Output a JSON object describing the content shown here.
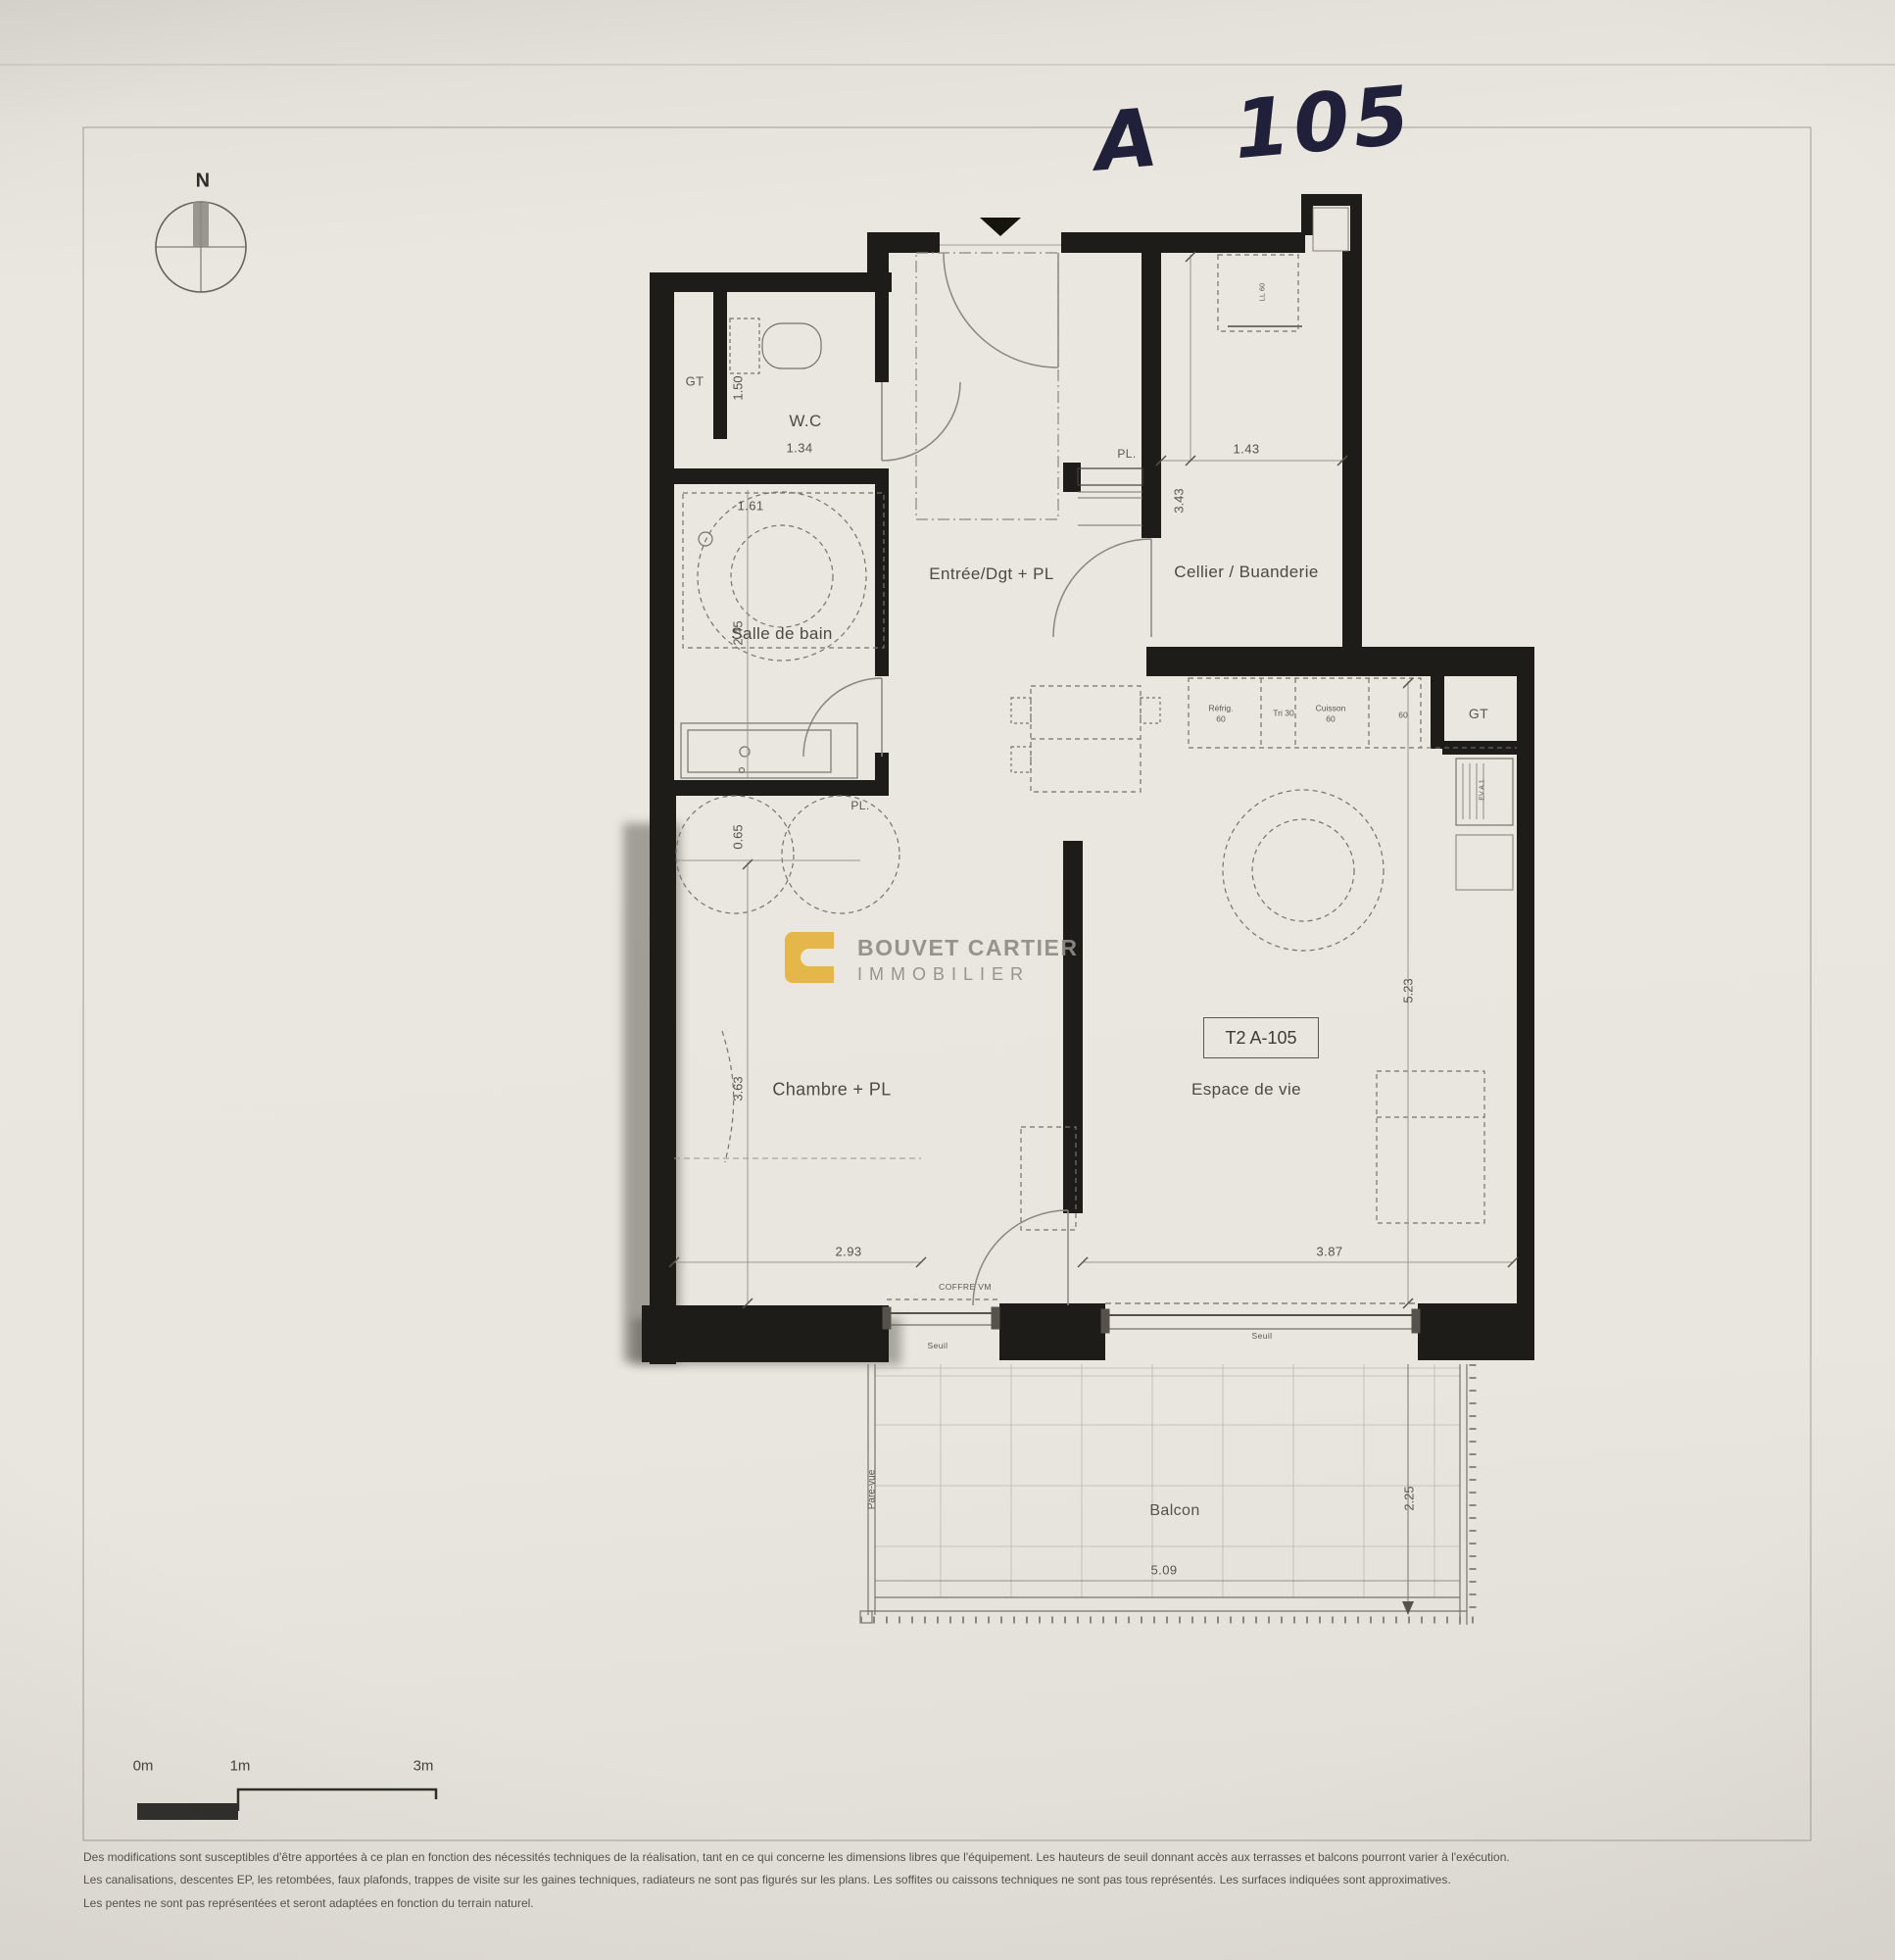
{
  "note": {
    "handwritten": "A 105"
  },
  "compass": {
    "north": "N"
  },
  "plan": {
    "unit_box_label": "T2 A-105",
    "rooms": {
      "wc": "W.C",
      "bathroom": "Salle de bain",
      "entry": "Entrée/Dgt + PL",
      "cellar": "Cellier / Buanderie",
      "bedroom": "Chambre + PL",
      "living": "Espace de vie",
      "balcony": "Balcon"
    },
    "dimensions": {
      "wc_width": "1.34",
      "wc_depth": "1.50",
      "bathroom_width": "1.61",
      "bathroom_depth": "2.45",
      "cellar_width": "1.43",
      "cellar_depth": "3.43",
      "bedroom_closet_depth": "0.65",
      "bedroom_depth": "3.63",
      "bedroom_width": "2.93",
      "living_width": "3.87",
      "living_depth": "5.23",
      "balcony_width": "5.09",
      "balcony_depth": "2.25"
    },
    "labels": {
      "gt_left": "GT",
      "gt_right": "GT",
      "pl_entry": "PL.",
      "pl_bedroom": "PL.",
      "coffre": "COFFRE VM",
      "seuil_bedroom": "Seuil",
      "seuil_living": "Seuil",
      "pare_vue": "Pare-vue",
      "washing_machine": "LL 60",
      "sink_unit": "EV A.1"
    },
    "kitchen": {
      "fridge": "Réfrig.",
      "fridge_size": "60",
      "bin": "Tri 30",
      "cooking": "Cuisson",
      "cooking_size": "60",
      "worktop_size": "60"
    }
  },
  "logo": {
    "line1": "BOUVET CARTIER",
    "line2": "IMMOBILIER"
  },
  "scale_bar": {
    "zero": "0m",
    "one": "1m",
    "three": "3m"
  },
  "disclaimer": {
    "line1": "Des modifications sont susceptibles d'être apportées à ce plan en fonction des nécessités techniques de la réalisation, tant en ce qui concerne les dimensions libres que l'équipement. Les hauteurs de seuil donnant accès aux terrasses et balcons pourront varier à l'exécution.",
    "line2": "Les canalisations, descentes EP, les retombées, faux plafonds, trappes de visite sur les gaines techniques, radiateurs ne sont pas figurés sur les plans. Les soffites ou caissons techniques ne sont pas tous représentés. Les surfaces indiquées sont approximatives.",
    "line3": "Les pentes ne sont pas représentées et seront adaptées en fonction du terrain naturel."
  },
  "colors": {
    "wall": "#1d1c19",
    "paper": "#eae7e0",
    "accent_gold": "#e5b33d",
    "ink": "#4c4a44"
  }
}
